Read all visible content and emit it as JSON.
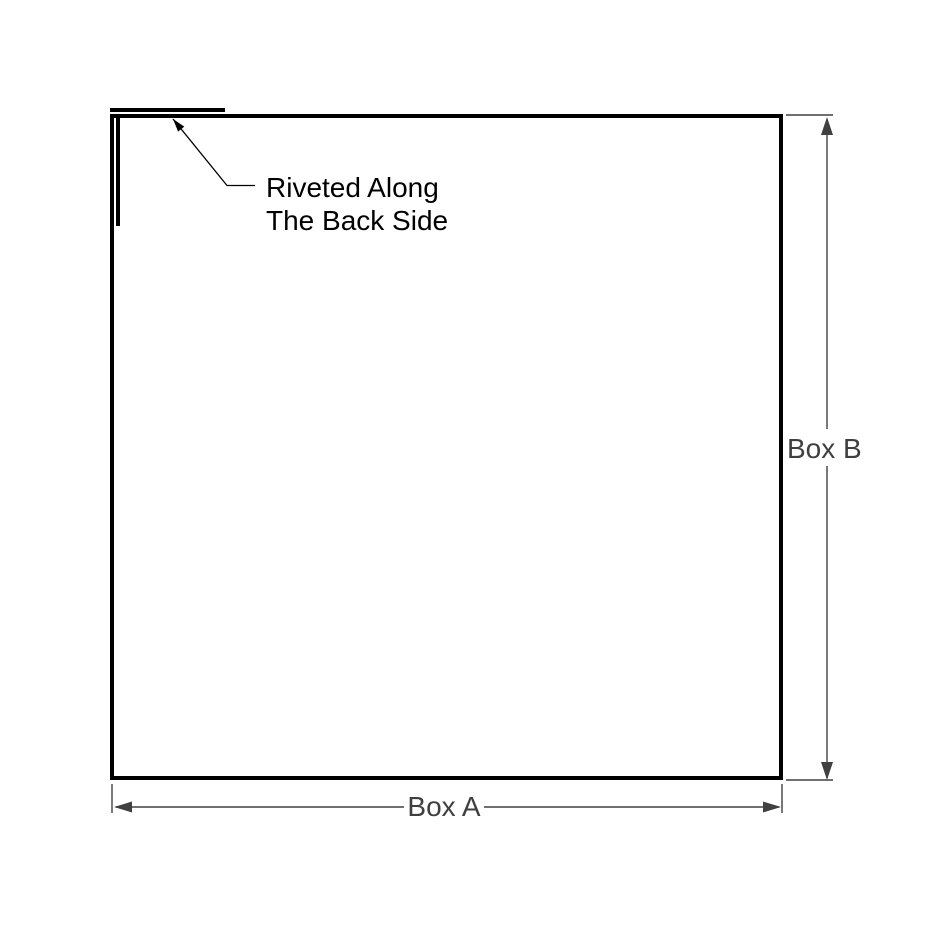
{
  "diagram": {
    "type": "technical-drawing",
    "annotation": {
      "line1": "Riveted Along",
      "line2": "The Back Side"
    },
    "dimensions": {
      "width_label": "Box A",
      "height_label": "Box B"
    },
    "colors": {
      "background": "#ffffff",
      "outline": "#000000",
      "dimension": "#404040",
      "annotation_text": "#000000",
      "dimension_text": "#3f3f3f"
    }
  }
}
